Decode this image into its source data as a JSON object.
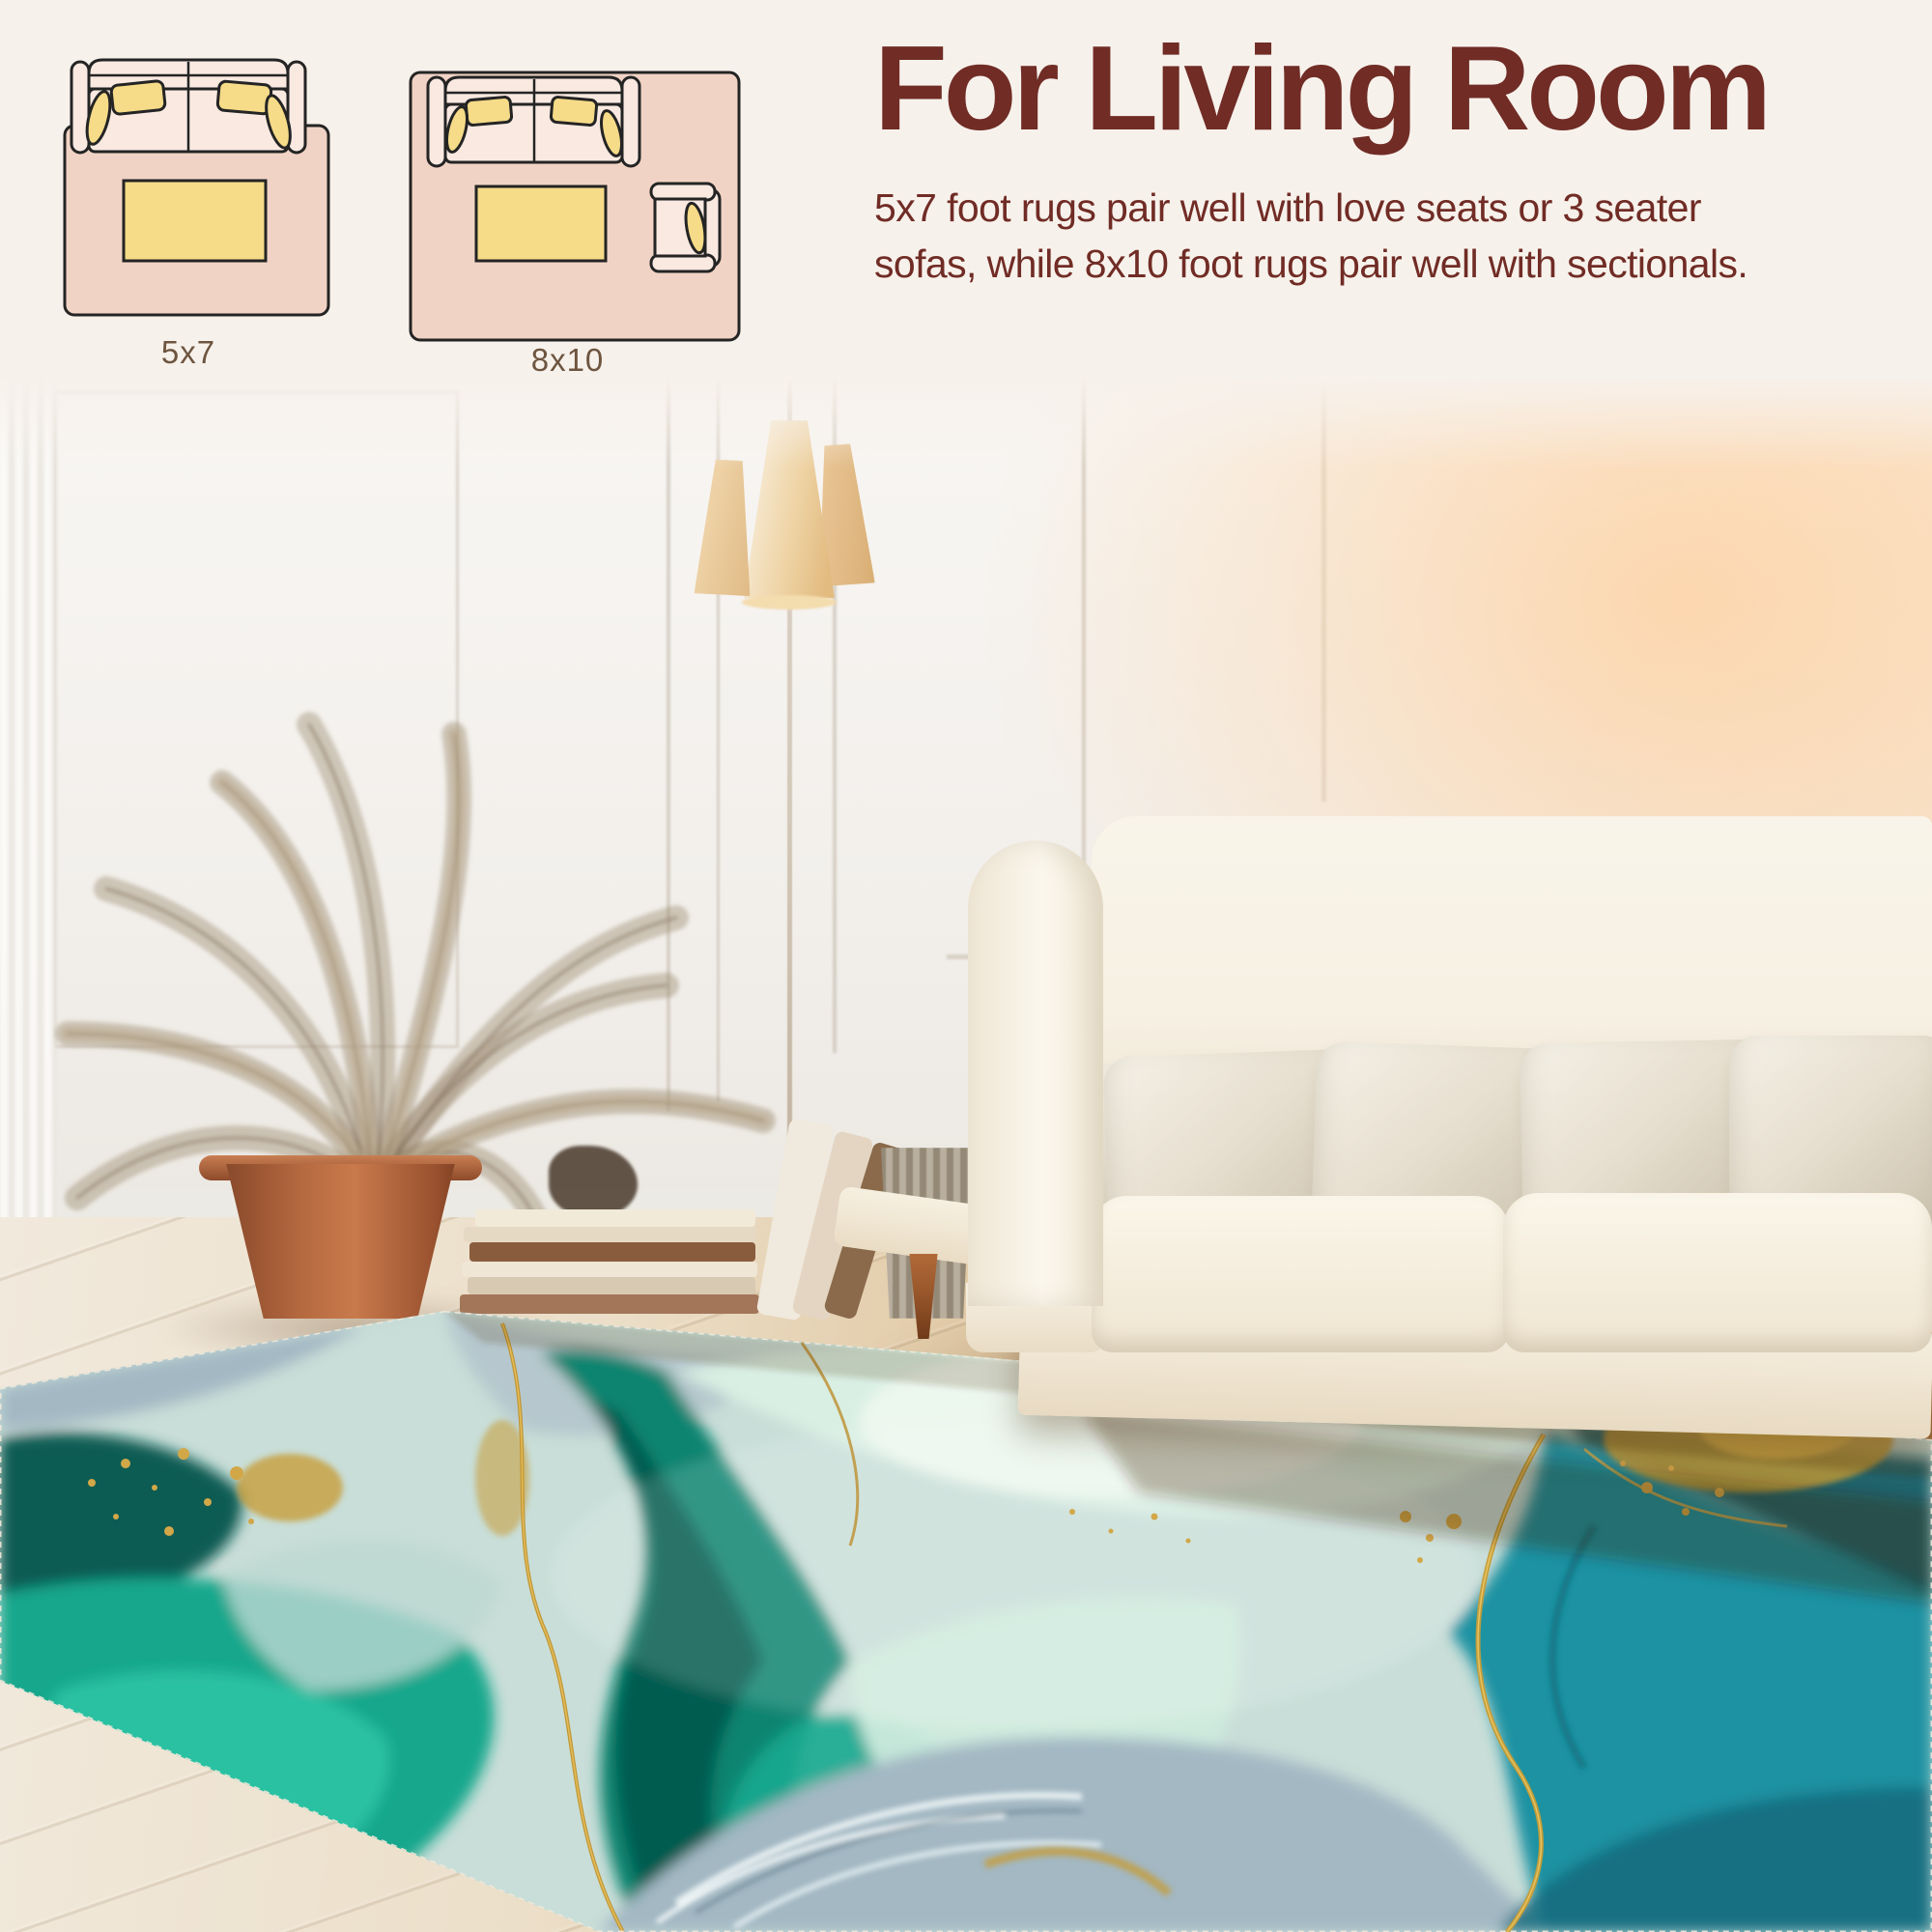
{
  "page": {
    "type": "rug product size-guide image"
  },
  "header": {
    "title": "For Living Room",
    "description_line1": "5x7 foot rugs pair well with love seats or 3 seater",
    "description_line2": "sofas, while 8x10 foot rugs pair well with sectionals."
  },
  "size_diagrams": [
    {
      "label": "5x7",
      "furniture_icons": [
        "loveseat-sofa-icon",
        "coffee-table-icon"
      ]
    },
    {
      "label": "8x10",
      "furniture_icons": [
        "three-seater-sofa-icon",
        "coffee-table-icon",
        "armchair-icon"
      ]
    }
  ],
  "photo": {
    "subject": "living room scene with teal and gold marble area rug",
    "visible_elements": [
      "white panel wall",
      "white curtain edge",
      "floor lamp with three cream cone shades",
      "dried palm plant",
      "terracotta pot",
      "stacked books",
      "leaning books",
      "gray vase",
      "cream sofa with beige pillows",
      "wood cone sofa legs",
      "whitewashed wood plank floor",
      "teal turquoise marble rug with gold veins"
    ]
  },
  "colors": {
    "maroon": "#702c25",
    "header_bg": "#f7f1eb",
    "label_brown": "#6d5540",
    "diagram_outline": "#242424",
    "diagram_rug": "#f1d3c5",
    "diagram_sofa": "#f9e9e1",
    "diagram_pillow": "#f6db88",
    "wall": "#f3f0ec",
    "glow": "#ffc98f",
    "lamp_shade": "#eed3a4",
    "lamp_stem": "#cfc2b1",
    "plant": "#9a8a72",
    "pot": "#b5693f",
    "sofa_cream": "#f7f1e4",
    "pillow_beige": "#e7dfd0",
    "leg_wood": "#99572b",
    "floor_light": "#efe7d8",
    "floor_warm": "#b67c44",
    "rug_teal": "#15a78c",
    "rug_teal_bright": "#2ec6a6",
    "rug_dark_teal": "#0a5c52",
    "rug_emerald": "#0e8470",
    "rug_emerald_dark": "#06564b",
    "rug_mint": "#d9efe3",
    "rug_gray_blue": "#a3b8c3",
    "rug_blue": "#1b92a2",
    "rug_blue_dark": "#0c5663",
    "rug_gold": "#c79b33"
  }
}
